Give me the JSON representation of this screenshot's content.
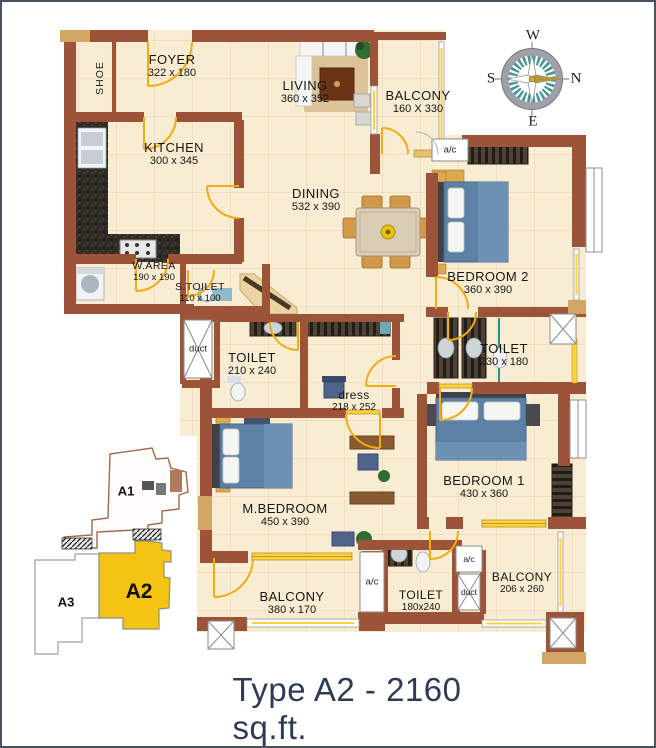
{
  "title": "Type A2 - 2160 sq.ft.",
  "compass": {
    "top": "W",
    "left": "S",
    "right": "N",
    "bottom": "E"
  },
  "rooms": {
    "foyer": {
      "name": "FOYER",
      "dims": "322 x 180"
    },
    "living": {
      "name": "LIVING",
      "dims": "360 x 352"
    },
    "balcony_top": {
      "name": "BALCONY",
      "dims": "160 X 330"
    },
    "kitchen": {
      "name": "KITCHEN",
      "dims": "300 x 345"
    },
    "dining": {
      "name": "DINING",
      "dims": "532 x 390"
    },
    "bedroom2": {
      "name": "BEDROOM 2",
      "dims": "360 x 390"
    },
    "warea": {
      "name": "W.AREA",
      "dims": "190 x 190"
    },
    "stoilet": {
      "name": "S.TOILET",
      "dims": "110 x 100"
    },
    "toilet_mid": {
      "name": "TOILET",
      "dims": "210 x 240"
    },
    "dress": {
      "name": "dress",
      "dims": "218 x 252"
    },
    "toilet_right": {
      "name": "TOILET",
      "dims": "230 x 180"
    },
    "mbedroom": {
      "name": "M.BEDROOM",
      "dims": "450 x 390"
    },
    "bedroom1": {
      "name": "BEDROOM 1",
      "dims": "430 x 360"
    },
    "balcony_bl": {
      "name": "BALCONY",
      "dims": "380 x 170"
    },
    "toilet_bottom": {
      "name": "TOILET",
      "dims": "180x240"
    },
    "balcony_br": {
      "name": "BALCONY",
      "dims": "206 x 260"
    }
  },
  "labels": {
    "shoe": "SHOE",
    "ac": "a/c",
    "duct": "duct"
  },
  "keyplan": {
    "a1": "A1",
    "a2": "A2",
    "a3": "A3",
    "highlight_color": "#f5c313"
  },
  "colors": {
    "wall": "#9d5338",
    "accent_tan": "#d2a766",
    "floor": "#f8ecd3",
    "door": "#f2ab10",
    "bed": "#5d81a4",
    "keyplan_highlight": "#f5c313",
    "title_text": "#2d3c54"
  }
}
